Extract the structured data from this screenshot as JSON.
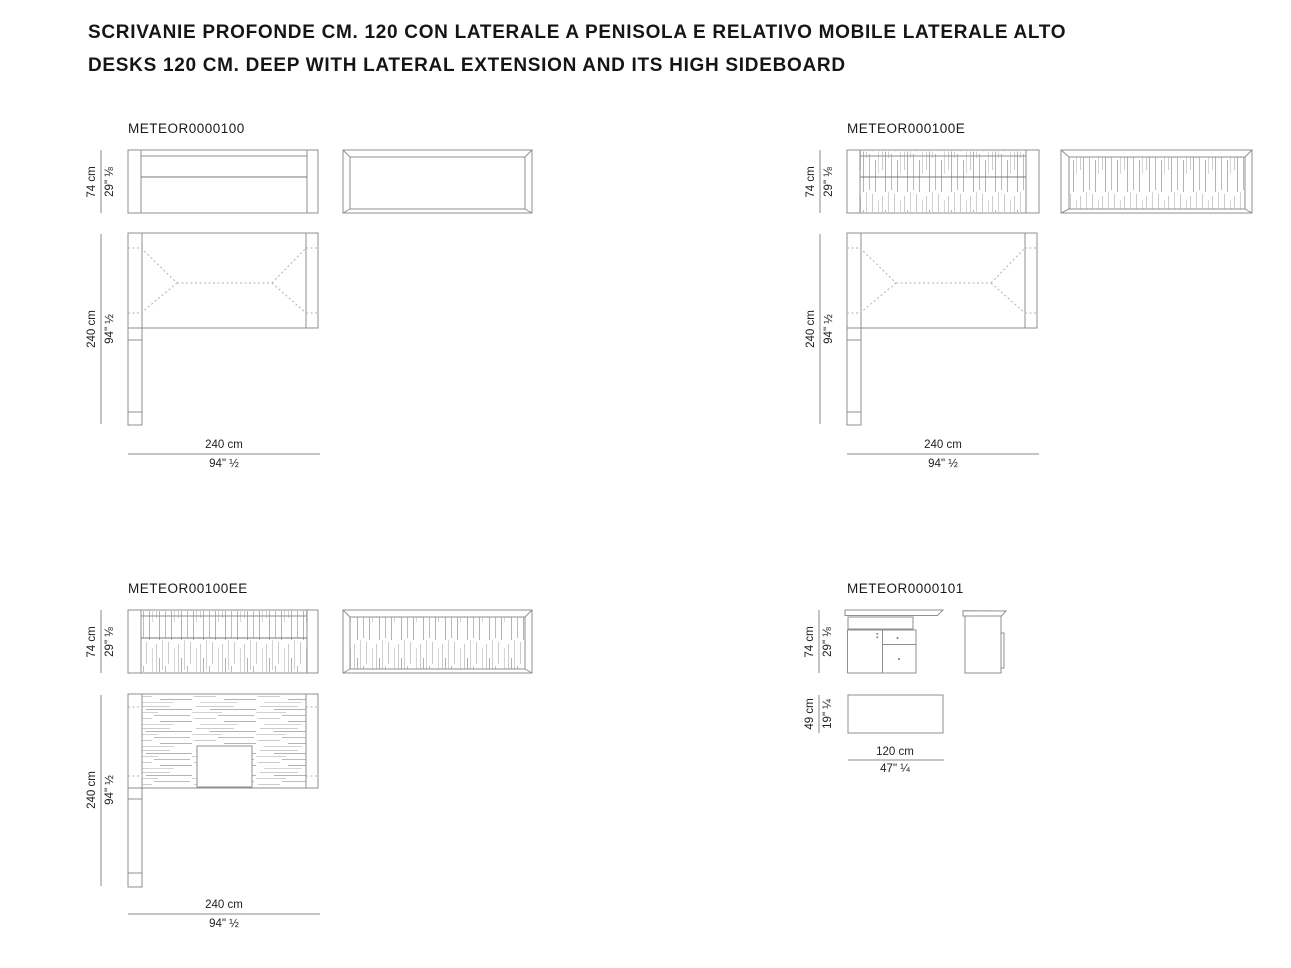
{
  "header": {
    "line1": "SCRIVANIE PROFONDE CM. 120 CON LATERALE A PENISOLA E RELATIVO MOBILE LATERALE ALTO",
    "line2": "DESKS 120 CM. DEEP WITH LATERAL EXTENSION AND ITS HIGH SIDEBOARD"
  },
  "diagrams": [
    {
      "code": "METEOR0000100",
      "height": {
        "cm": "74 cm",
        "in": "29\" ⅛"
      },
      "depth": {
        "cm": "240 cm",
        "in": "94\" ½"
      },
      "width": {
        "cm": "240 cm",
        "in": "94\" ½"
      }
    },
    {
      "code": "METEOR000100E",
      "height": {
        "cm": "74 cm",
        "in": "29\" ⅛"
      },
      "depth": {
        "cm": "240 cm",
        "in": "94\" ½"
      },
      "width": {
        "cm": "240 cm",
        "in": "94\" ½"
      }
    },
    {
      "code": "METEOR00100EE",
      "height": {
        "cm": "74 cm",
        "in": "29\" ⅛"
      },
      "depth": {
        "cm": "240 cm",
        "in": "94\" ½"
      },
      "width": {
        "cm": "240 cm",
        "in": "94\" ½"
      }
    },
    {
      "code": "METEOR0000101",
      "height": {
        "cm": "74 cm",
        "in": "29\" ⅛"
      },
      "depth": {
        "cm": "49 cm",
        "in": "19\" ¼"
      },
      "width": {
        "cm": "120 cm",
        "in": "47\" ¼"
      }
    }
  ],
  "colors": {
    "line": "#8f8f8f",
    "text": "#1a1a1a",
    "texture_light": "#cccccc",
    "texture_dark": "#b3b3b3",
    "dotted": "#b2b2b2"
  }
}
